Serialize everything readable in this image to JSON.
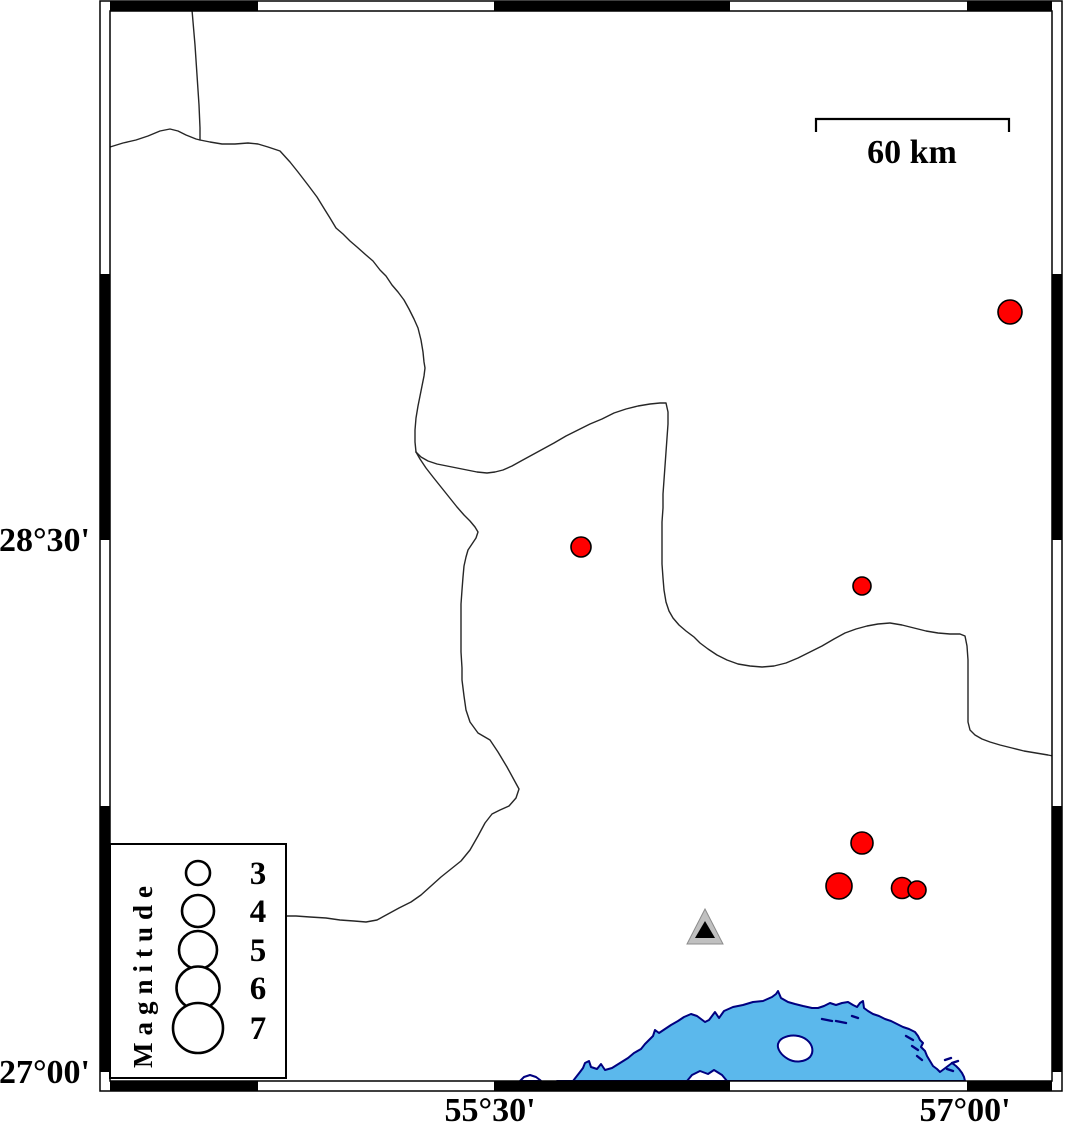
{
  "axis": {
    "left_labels": [
      {
        "text": "28°30'",
        "y": 540
      },
      {
        "text": "27°00'",
        "y": 1072
      }
    ],
    "bottom_labels": [
      {
        "text": "55°30'",
        "x": 490
      },
      {
        "text": "57°00'",
        "x": 965
      }
    ]
  },
  "scalebar": {
    "label": "60 km"
  },
  "legend": {
    "title": "Magnitude",
    "circle_x": 198,
    "label_x": 258,
    "entries": [
      {
        "label": "3",
        "cy": 873,
        "r": 12
      },
      {
        "label": "4",
        "cy": 911,
        "r": 16
      },
      {
        "label": "5",
        "cy": 950,
        "r": 19
      },
      {
        "label": "6",
        "cy": 988,
        "r": 21.5
      },
      {
        "label": "7",
        "cy": 1028,
        "r": 25
      }
    ]
  },
  "events": [
    {
      "cx": 1010,
      "cy": 312,
      "r": 12
    },
    {
      "cx": 581,
      "cy": 547,
      "r": 10
    },
    {
      "cx": 862,
      "cy": 586,
      "r": 9
    },
    {
      "cx": 862,
      "cy": 843,
      "r": 11
    },
    {
      "cx": 839,
      "cy": 886,
      "r": 13
    },
    {
      "cx": 902,
      "cy": 888,
      "r": 10.5
    },
    {
      "cx": 917,
      "cy": 890,
      "r": 9
    }
  ],
  "station": {
    "outer": "M705,909 L687,944 L723,944 Z",
    "inner": "M705,921 L695,938 L715,938 Z"
  },
  "frame": {
    "h_black": [
      [
        110,
        258
      ],
      [
        494,
        730
      ],
      [
        967,
        1052
      ]
    ],
    "v_black": [
      [
        274,
        540
      ],
      [
        806,
        1072
      ]
    ]
  },
  "colors": {
    "event_fill": "#ff0000",
    "water_fill": "#5bb8ec",
    "coast_stroke": "#000080",
    "boundary_stroke": "#262626",
    "station_outer_fill": "#c0c0c0",
    "station_inner_fill": "#000000",
    "frame_black": "#000000",
    "land_fill": "#ffffff"
  },
  "paths": {
    "boundary_top": "M192,10 L195,45 L197,75 L199,105 L200,128 L200,140",
    "boundary_west": "M110,147 L123,143 L136,140 L148,136 L160,131 L170,129 L178,131 L186,135 L196,139 L200,140 L210,142 L222,144 L235,144 L248,143 L258,144 L268,147 L280,151 L290,162 L298,172 L308,185 L317,197 L325,210 L330,218 L336,228 L343,234 L350,241 L357,247 L366,255 L373,261 L380,270 L386,276 L392,285 L398,292 L404,300 L409,309 L414,319 L418,328 L421,340 L423,352 L424,362 L425,368 L424,376 L422,386 L420,396 L418,406 L416,418 L415,430 L415,442 L416,452",
    "boundary_east": "M416,452 L421,457 L428,461 L437,464 L447,466 L457,468 L467,470 L477,472 L487,473 L495,472 L503,470 L512,466 L521,461 L532,455 L543,449 L554,443 L566,436 L578,430 L590,424 L602,419 L614,413 L626,409 L638,406 L650,404 L660,403 L666,403 L668,412 L668,424 L667,438 L666,452 L665,466 L664,480 L663,494 L663,508 L662,522 L662,536 L662,550 L662,564 L663,578 L664,590 L666,602 L669,611 L673,618 L679,625 L686,631 L694,637 L700,643 L708,649 L717,655 L727,660 L738,664 L750,666 L762,667 L774,666 L786,663 L798,658 L810,652 L822,646 L834,639 L845,633 L856,629 L867,626 L878,624 L890,623 L902,625 L914,628 L926,631 L938,633 L950,634 L960,634 L965,636 L967,646 L968,660 L968,676 L968,692 L968,708 L968,722 L970,730 L975,735 L982,739 L990,742 L1000,745 L1012,748 L1024,751 L1036,753 L1048,755 L1053,756",
    "boundary_south": "M416,452 L420,459 L426,468 L433,477 L441,487 L449,497 L457,507 L464,515 L470,521 L475,527 L478,532 L476,538 L472,544 L468,550 L466,557 L464,566 L463,577 L462,590 L461,604 L461,620 L461,636 L461,652 L462,668 L462,680 L464,696 L466,710 L470,722 L478,733 L490,740 L498,752 L507,767 L513,778 L519,789 L516,798 L509,806 L500,810 L492,814 L485,823 L478,836 L470,850 L461,861 L451,869 L441,877 L431,886 L421,895 L411,902 L399,908 L388,914 L377,920 L366,922 L354,921 L340,920 L326,918 L310,917 L296,916 L287,916",
    "water": "M557,1081 L573,1081 L580,1072 L583,1068 L585,1063 L589,1061 L591,1067 L597,1069 L601,1064 L605,1070 L612,1068 L620,1063 L628,1058 L634,1053 L641,1049 L645,1044 L649,1040 L653,1036 L655,1030 L659,1033 L665,1029 L671,1025 L678,1021 L684,1017 L691,1014 L697,1016 L701,1019 L705,1022 L709,1020 L712,1016 L715,1012 L719,1018 L724,1011 L733,1007 L743,1005 L753,1002 L763,1001 L772,997 L776,994 L778,991 L781,998 L788,1002 L795,1004 L803,1006 L812,1008 L818,1008 L824,1006 L830,1003 L836,1005 L842,1003 L848,1002 L853,1005 L857,1007 L860,1003 L863,1001 L864,1008 L868,1011 L873,1014 L879,1016 L885,1019 L891,1021 L897,1024 L903,1027 L909,1029 L915,1032 L918,1036 L920,1040 L923,1043 L921,1047 L925,1051 L927,1056 L930,1061 L933,1066 L937,1069 L940,1072 L944,1069 L948,1066 L952,1063 L956,1066 L959,1069 L962,1073 L964,1077 L965,1081 Z",
    "island": "M783,1038 C791,1034 801,1035 807,1040 C813,1045 814,1052 810,1057 C805,1062 795,1063 788,1059 C781,1055 777,1049 778,1044 C779,1041 781,1039 783,1038 Z",
    "islet": "M687,1081 L692,1075 L700,1071 L708,1074 L714,1070 L722,1075 L727,1081 Z",
    "west_bump": "M520,1081 L524,1077 L530,1075 L536,1077 L540,1080 L541,1081 Z",
    "scalebar": "M816,132 L816,119 L1009,119 L1009,132",
    "dashes": [
      "M822,1019 L832,1021",
      "M836,1021 L846,1023",
      "M852,1016 L858,1018",
      "M906,1036 L913,1040",
      "M912,1046 L918,1050",
      "M917,1056 L922,1060",
      "M945,1060 L951,1058",
      "M952,1063 L958,1061",
      "M947,1069 L953,1071"
    ]
  }
}
